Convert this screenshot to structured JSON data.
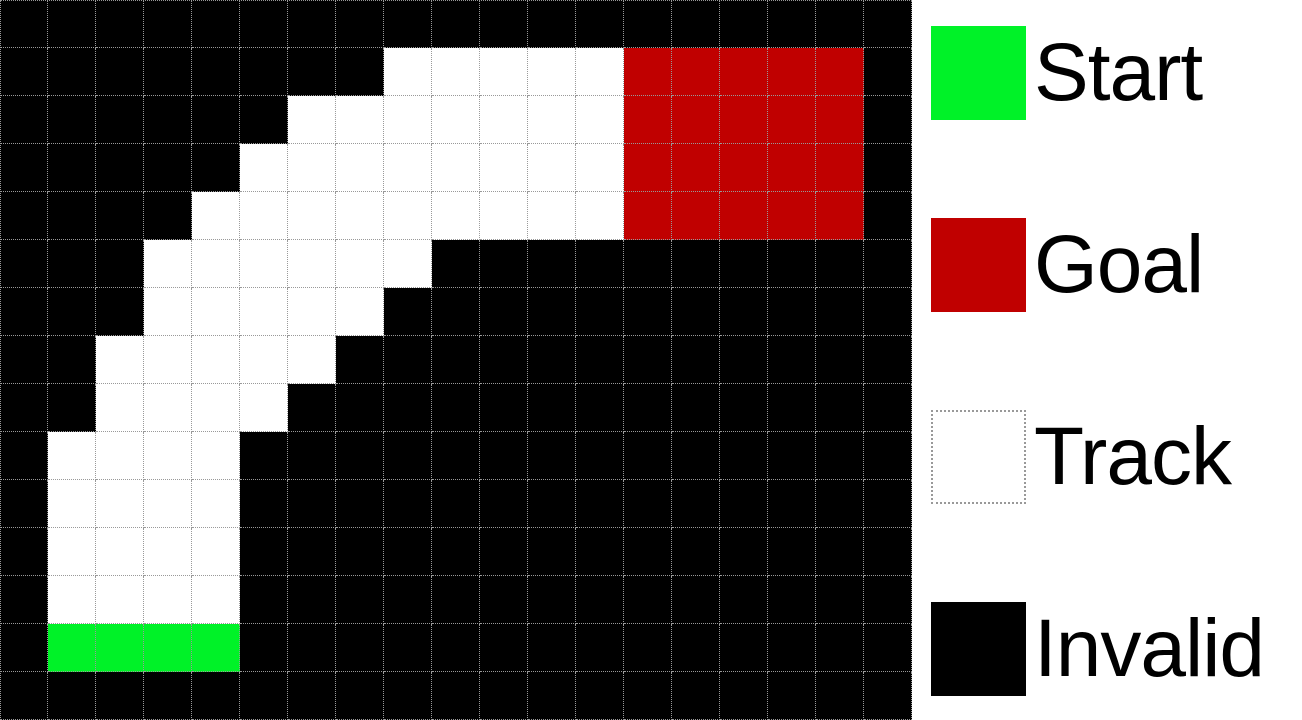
{
  "figure": {
    "kind": "racetrack-grid-visualization"
  },
  "grid": {
    "columns": 19,
    "rows": 15,
    "cell_size_px": 48,
    "cell_key": {
      "K": "invalid",
      "T": "track",
      "S": "start",
      "G": "goal"
    },
    "map": [
      "KKKKKKKKKKKKKKKKKKK",
      "KKKKKKKKTTTTTGGGGGK",
      "KKKKKKTTTTTTTGGGGGK",
      "KKKKKTTTTTTTTGGGGGK",
      "KKKKTTTTTTTTTGGGGGK",
      "KKKTTTTTTKKKKKKKKKK",
      "KKKTTTTTKKKKKKKKKKK",
      "KKTTTTTKKKKKKKKKKKK",
      "KKTTTTKKKKKKKKKKKKK",
      "KTTTTKKKKKKKKKKKKKK",
      "KTTTTKKKKKKKKKKKKKK",
      "KTTTTKKKKKKKKKKKKKK",
      "KTTTTKKKKKKKKKKKKKK",
      "KSSSSKKKKKKKKKKKKKK",
      "KKKKKKKKKKKKKKKKKKK"
    ]
  },
  "colors": {
    "start": "#00F228",
    "goal": "#C00000",
    "track": "#FFFFFF",
    "invalid": "#000000",
    "gridline": "#999999",
    "panel_background": "#FFFFFF",
    "label_text": "#000000"
  },
  "legend": {
    "items": [
      {
        "label": "Start",
        "type": "start"
      },
      {
        "label": "Goal",
        "type": "goal"
      },
      {
        "label": "Track",
        "type": "track"
      },
      {
        "label": "Invalid",
        "type": "invalid"
      }
    ]
  }
}
